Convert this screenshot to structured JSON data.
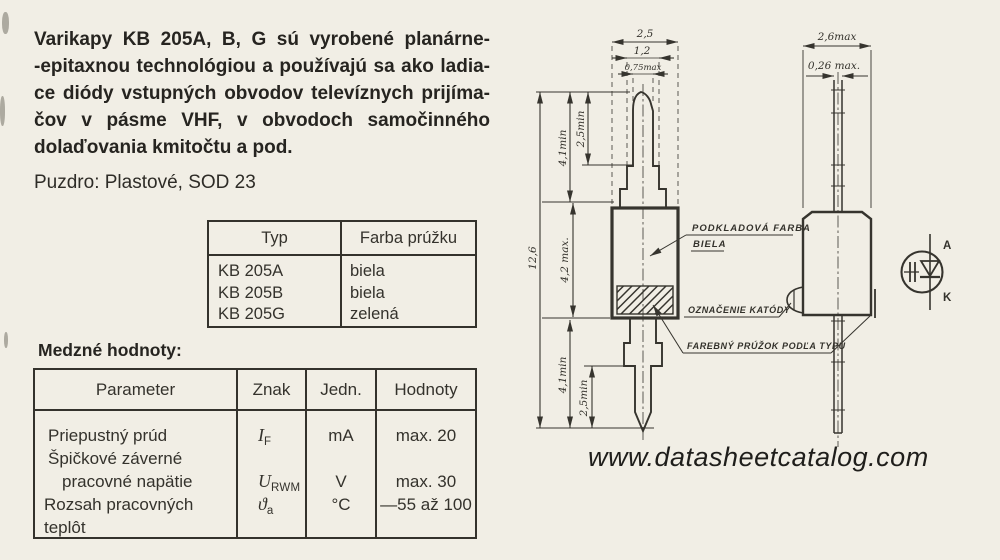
{
  "intro": {
    "lines": [
      "Varikapy KB 205A, B, G sú vyrobené planárne-",
      "-epitaxnou technológiou a používajú sa ako ladia-",
      "ce diódy vstupných obvodov televíznych prijíma-",
      "čov v pásme VHF, v obvodoch samočinného",
      "dolaďovania kmitočtu a pod."
    ],
    "package_line": "Puzdro: Plastové, SOD 23"
  },
  "type_table": {
    "col1": "Typ",
    "col2": "Farba prúžku",
    "rows": [
      {
        "typ": "KB 205A",
        "farba": "biela"
      },
      {
        "typ": "KB 205B",
        "farba": "biela"
      },
      {
        "typ": "KB 205G",
        "farba": "zelená"
      }
    ]
  },
  "limits_table": {
    "title": "Medzné hodnoty:",
    "headers": [
      "Parameter",
      "Znak",
      "Jedn.",
      "Hodnoty"
    ],
    "param_lines": [
      "Priepustný prúd",
      "Špičkové záverné",
      "pracovné napätie",
      "Rozsah pracovných teplôt"
    ],
    "znak": [
      {
        "base": "I",
        "sub": "F"
      },
      {
        "base": "U",
        "sub": "RWM"
      },
      {
        "base": "ϑ",
        "sub": "a"
      }
    ],
    "jedn": [
      "mA",
      "V",
      "°C"
    ],
    "hodnoty": [
      "max. 20",
      "max. 30",
      "—55 až 100"
    ]
  },
  "drawing": {
    "front_dims": {
      "body_width": "2,5",
      "collar_width": "1,2",
      "pin_width": "0,75max",
      "total_height": "12,6",
      "lead_top": "4,1min",
      "pin_top": "2,5min",
      "body_height": "4,2 max.",
      "lead_bottom": "4,1min",
      "pin_bottom": "2,5min"
    },
    "side_dims": {
      "width": "2,6max",
      "thickness": "0,26 max."
    },
    "callouts": {
      "base_color_1": "PODKLADOVÁ FARBA",
      "base_color_2": "BIELA",
      "cathode_mark": "OZNAČENIE KATÓDY",
      "stripe": "FAREBNÝ PRÚŽOK PODĽA TYPU"
    },
    "symbol": {
      "anode": "A",
      "cathode": "K"
    }
  },
  "footer": {
    "watermark": "www.datasheetcatalog.com"
  }
}
